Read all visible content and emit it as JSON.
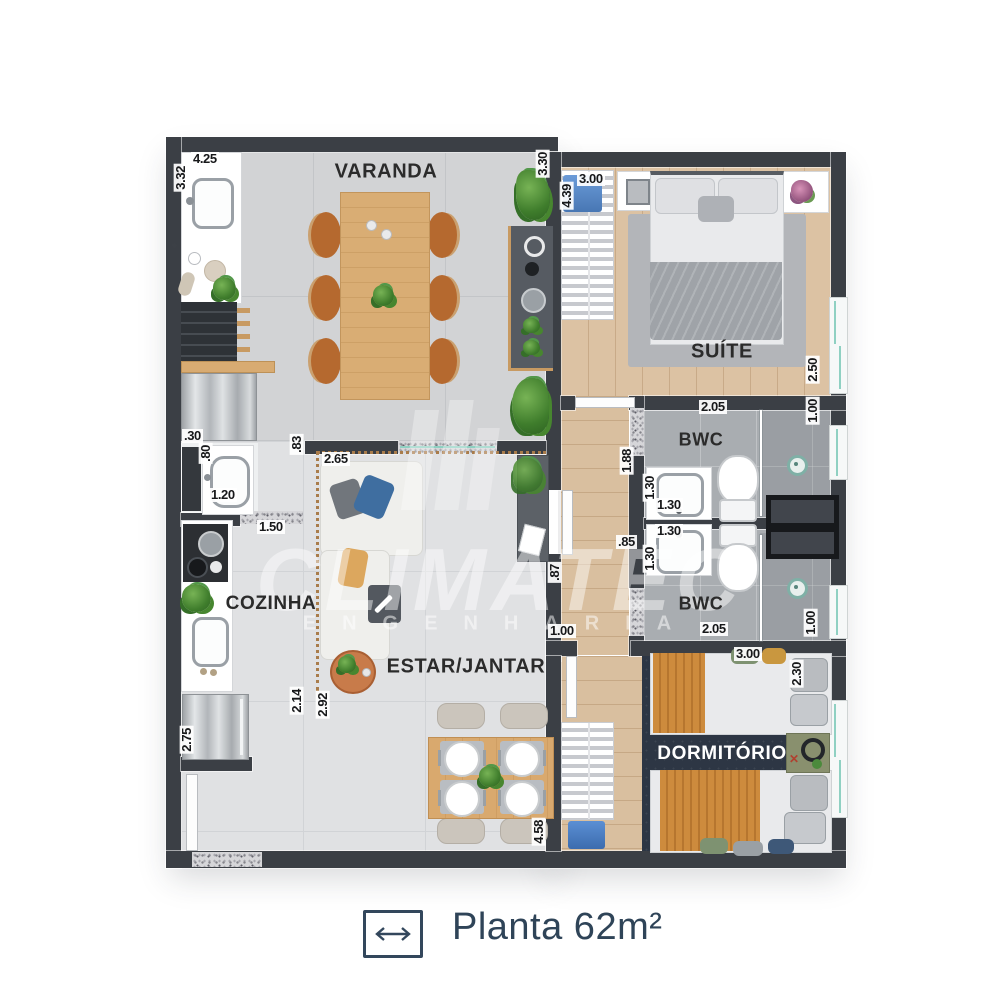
{
  "watermark": {
    "line1": "CLIMATEC",
    "line2": "ENGENHARIA"
  },
  "caption": {
    "icon": "width-arrow",
    "text": "Planta 62m²"
  },
  "rooms": [
    {
      "name": "varanda",
      "label": "VARANDA",
      "cx": 386,
      "cy": 172,
      "fs": 20,
      "color": "#2b2b2b"
    },
    {
      "name": "suite",
      "label": "SUÍTE",
      "cx": 722,
      "cy": 352,
      "fs": 20,
      "color": "#2b2b2b"
    },
    {
      "name": "bwc-1",
      "label": "BWC",
      "cx": 701,
      "cy": 440,
      "fs": 18,
      "color": "#2b2b2b"
    },
    {
      "name": "bwc-2",
      "label": "BWC",
      "cx": 701,
      "cy": 604,
      "fs": 18,
      "color": "#2b2b2b"
    },
    {
      "name": "dormitorio",
      "label": "DORMITÓRIO",
      "cx": 722,
      "cy": 754,
      "fs": 19,
      "color": "#ffffff"
    },
    {
      "name": "estar-jantar",
      "label": "ESTAR/JANTAR",
      "cx": 466,
      "cy": 667,
      "fs": 20,
      "color": "#2b2b2b"
    },
    {
      "name": "cozinha",
      "label": "COZINHA",
      "cx": 271,
      "cy": 604,
      "fs": 19,
      "color": "#2b2b2b"
    }
  ],
  "dimensions": [
    {
      "t": "4.25",
      "x": 191,
      "y": 152
    },
    {
      "t": "3.32",
      "x": 174,
      "y": 164,
      "v": 1
    },
    {
      "t": "3.30",
      "x": 536,
      "y": 150,
      "v": 1
    },
    {
      "t": "3.00",
      "x": 577,
      "y": 172
    },
    {
      "t": "4.39",
      "x": 560,
      "y": 182,
      "v": 1
    },
    {
      "t": "2.50",
      "x": 806,
      "y": 356,
      "v": 1
    },
    {
      "t": "2.05",
      "x": 699,
      "y": 400
    },
    {
      "t": "1.00",
      "x": 806,
      "y": 397,
      "v": 1
    },
    {
      "t": "1.88",
      "x": 620,
      "y": 447,
      "v": 1
    },
    {
      "t": "1.30",
      "x": 643,
      "y": 474,
      "v": 1
    },
    {
      "t": "1.30",
      "x": 655,
      "y": 498
    },
    {
      "t": "1.30",
      "x": 655,
      "y": 524
    },
    {
      "t": ".85",
      "x": 616,
      "y": 535
    },
    {
      "t": "1.30",
      "x": 643,
      "y": 545,
      "v": 1
    },
    {
      "t": "2.05",
      "x": 700,
      "y": 622
    },
    {
      "t": "1.00",
      "x": 804,
      "y": 609,
      "v": 1
    },
    {
      "t": "3.00",
      "x": 734,
      "y": 647
    },
    {
      "t": "2.30",
      "x": 790,
      "y": 660,
      "v": 1
    },
    {
      "t": ".30",
      "x": 182,
      "y": 429
    },
    {
      "t": ".80",
      "x": 199,
      "y": 443,
      "v": 1
    },
    {
      "t": "1.20",
      "x": 209,
      "y": 488
    },
    {
      "t": "1.50",
      "x": 257,
      "y": 520
    },
    {
      "t": ".83",
      "x": 290,
      "y": 434,
      "v": 1
    },
    {
      "t": "2.65",
      "x": 322,
      "y": 452
    },
    {
      "t": "2.14",
      "x": 290,
      "y": 687,
      "v": 1
    },
    {
      "t": "2.92",
      "x": 316,
      "y": 691,
      "v": 1
    },
    {
      "t": ".87",
      "x": 548,
      "y": 562,
      "v": 1
    },
    {
      "t": "1.00",
      "x": 548,
      "y": 624
    },
    {
      "t": "2.75",
      "x": 180,
      "y": 726,
      "v": 1
    },
    {
      "t": "4.58",
      "x": 532,
      "y": 818,
      "v": 1
    }
  ]
}
